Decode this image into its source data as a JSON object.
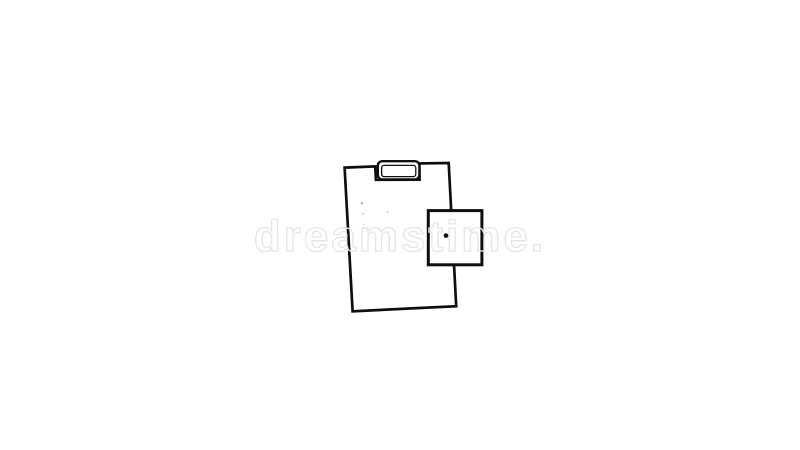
{
  "canvas": {
    "width": 800,
    "height": 450,
    "background": "#ffffff"
  },
  "watermark": {
    "text": "dreamstime.",
    "color": "#e5e5e5"
  },
  "illustration": {
    "name": "hand-drawn-clipboard-with-blank-square-doodle",
    "stroke_color": "#0e0e0e",
    "fill_color": "#ffffff",
    "dot_color": "#0e0e0e",
    "speck_color": "#8a8a8a"
  }
}
